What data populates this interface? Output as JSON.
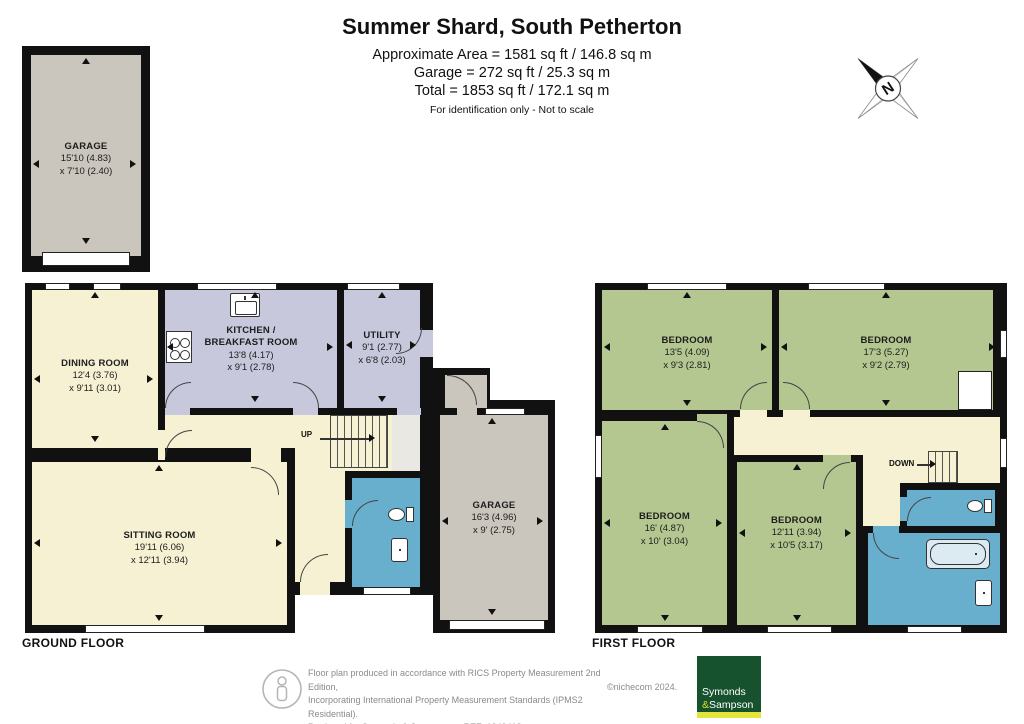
{
  "header": {
    "title": "Summer Shard, South Petherton",
    "area_line": "Approximate Area = 1581 sq ft / 146.8 sq m",
    "garage_line": "Garage = 272 sq ft / 25.3 sq m",
    "total_line": "Total = 1853 sq ft / 172.1 sq m",
    "disclaimer": "For identification only - Not to scale"
  },
  "compass": {
    "north_label": "N"
  },
  "detached_garage": {
    "name": "GARAGE",
    "d1": "15'10 (4.83)",
    "d2": "x 7'10 (2.40)"
  },
  "ground_floor": {
    "caption": "GROUND FLOOR",
    "stairs_label": "UP",
    "dining": {
      "name": "DINING ROOM",
      "d1": "12'4 (3.76)",
      "d2": "x 9'11 (3.01)"
    },
    "kitchen": {
      "name": "KITCHEN /",
      "name2": "BREAKFAST ROOM",
      "d1": "13'8 (4.17)",
      "d2": "x 9'1 (2.78)"
    },
    "utility": {
      "name": "UTILITY",
      "d1": "9'1 (2.77)",
      "d2": "x 6'8 (2.03)"
    },
    "sitting": {
      "name": "SITTING ROOM",
      "d1": "19'11 (6.06)",
      "d2": "x 12'11 (3.94)"
    },
    "garage": {
      "name": "GARAGE",
      "d1": "16'3 (4.96)",
      "d2": "x 9' (2.75)"
    }
  },
  "first_floor": {
    "caption": "FIRST FLOOR",
    "stairs_label": "DOWN",
    "bed1": {
      "name": "BEDROOM",
      "d1": "13'5 (4.09)",
      "d2": "x 9'3 (2.81)"
    },
    "bed2": {
      "name": "BEDROOM",
      "d1": "17'3 (5.27)",
      "d2": "x 9'2 (2.79)"
    },
    "bed3": {
      "name": "BEDROOM",
      "d1": "16' (4.87)",
      "d2": "x 10' (3.04)"
    },
    "bed4": {
      "name": "BEDROOM",
      "d1": "12'11 (3.94)",
      "d2": "x 10'5 (3.17)"
    }
  },
  "footer": {
    "line1": "Floor plan produced in accordance with RICS Property Measurement 2nd Edition,",
    "line2": "Incorporating International Property Measurement Standards (IPMS2 Residential).",
    "produced_for": "Produced for Symonds & Sampson.",
    "ref": "REF: 1349418",
    "copyright": "©nichecom 2024.",
    "logo_top": "Symonds",
    "logo_amp": "&",
    "logo_bottom": "Sampson"
  },
  "colors": {
    "room_cream": "#f6f1d2",
    "room_lavender": "#c7c8dc",
    "room_green": "#b5c791",
    "room_blue": "#68afcd",
    "room_gray": "#cac5bd",
    "hall_gray": "#e9e8e2",
    "wall": "#111111",
    "logo_green": "#17522e",
    "logo_yellow": "#e5e43c"
  }
}
